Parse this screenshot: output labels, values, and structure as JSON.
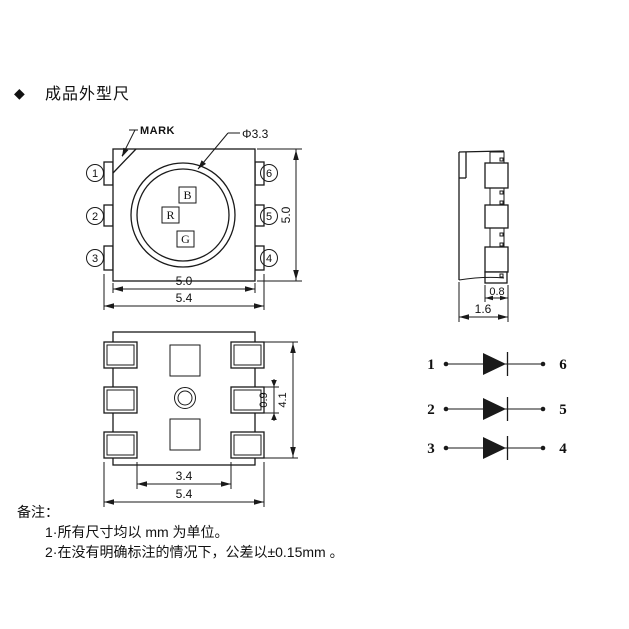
{
  "title": {
    "bullet": "◆",
    "text": "成品外型尺"
  },
  "top_view": {
    "mark_label": "MARK",
    "lens_diameter": "Φ3.3",
    "pins_left": [
      "1",
      "2",
      "3"
    ],
    "pins_right": [
      "6",
      "5",
      "4"
    ],
    "dies": [
      "B",
      "R",
      "G"
    ],
    "dim_body_width": "5.0",
    "dim_total_width": "5.4",
    "dim_body_height": "5.0"
  },
  "side_view": {
    "dim_lead_width": "0.8",
    "dim_thickness": "1.6"
  },
  "bottom_view": {
    "dim_pad_span": "3.4",
    "dim_total_width": "5.4",
    "dim_pad_height": "0.9",
    "dim_pad_column_height": "4.1"
  },
  "circuit": {
    "rows": [
      {
        "left": "1",
        "right": "6"
      },
      {
        "left": "2",
        "right": "5"
      },
      {
        "left": "3",
        "right": "4"
      }
    ]
  },
  "notes": {
    "heading": "备注：",
    "items": [
      "1·所有尺寸均以 mm 为单位。",
      "2·在没有明确标注的情况下，公差以±0.15mm 。"
    ]
  },
  "colors": {
    "line": "#1a1a1a",
    "background": "#ffffff"
  }
}
